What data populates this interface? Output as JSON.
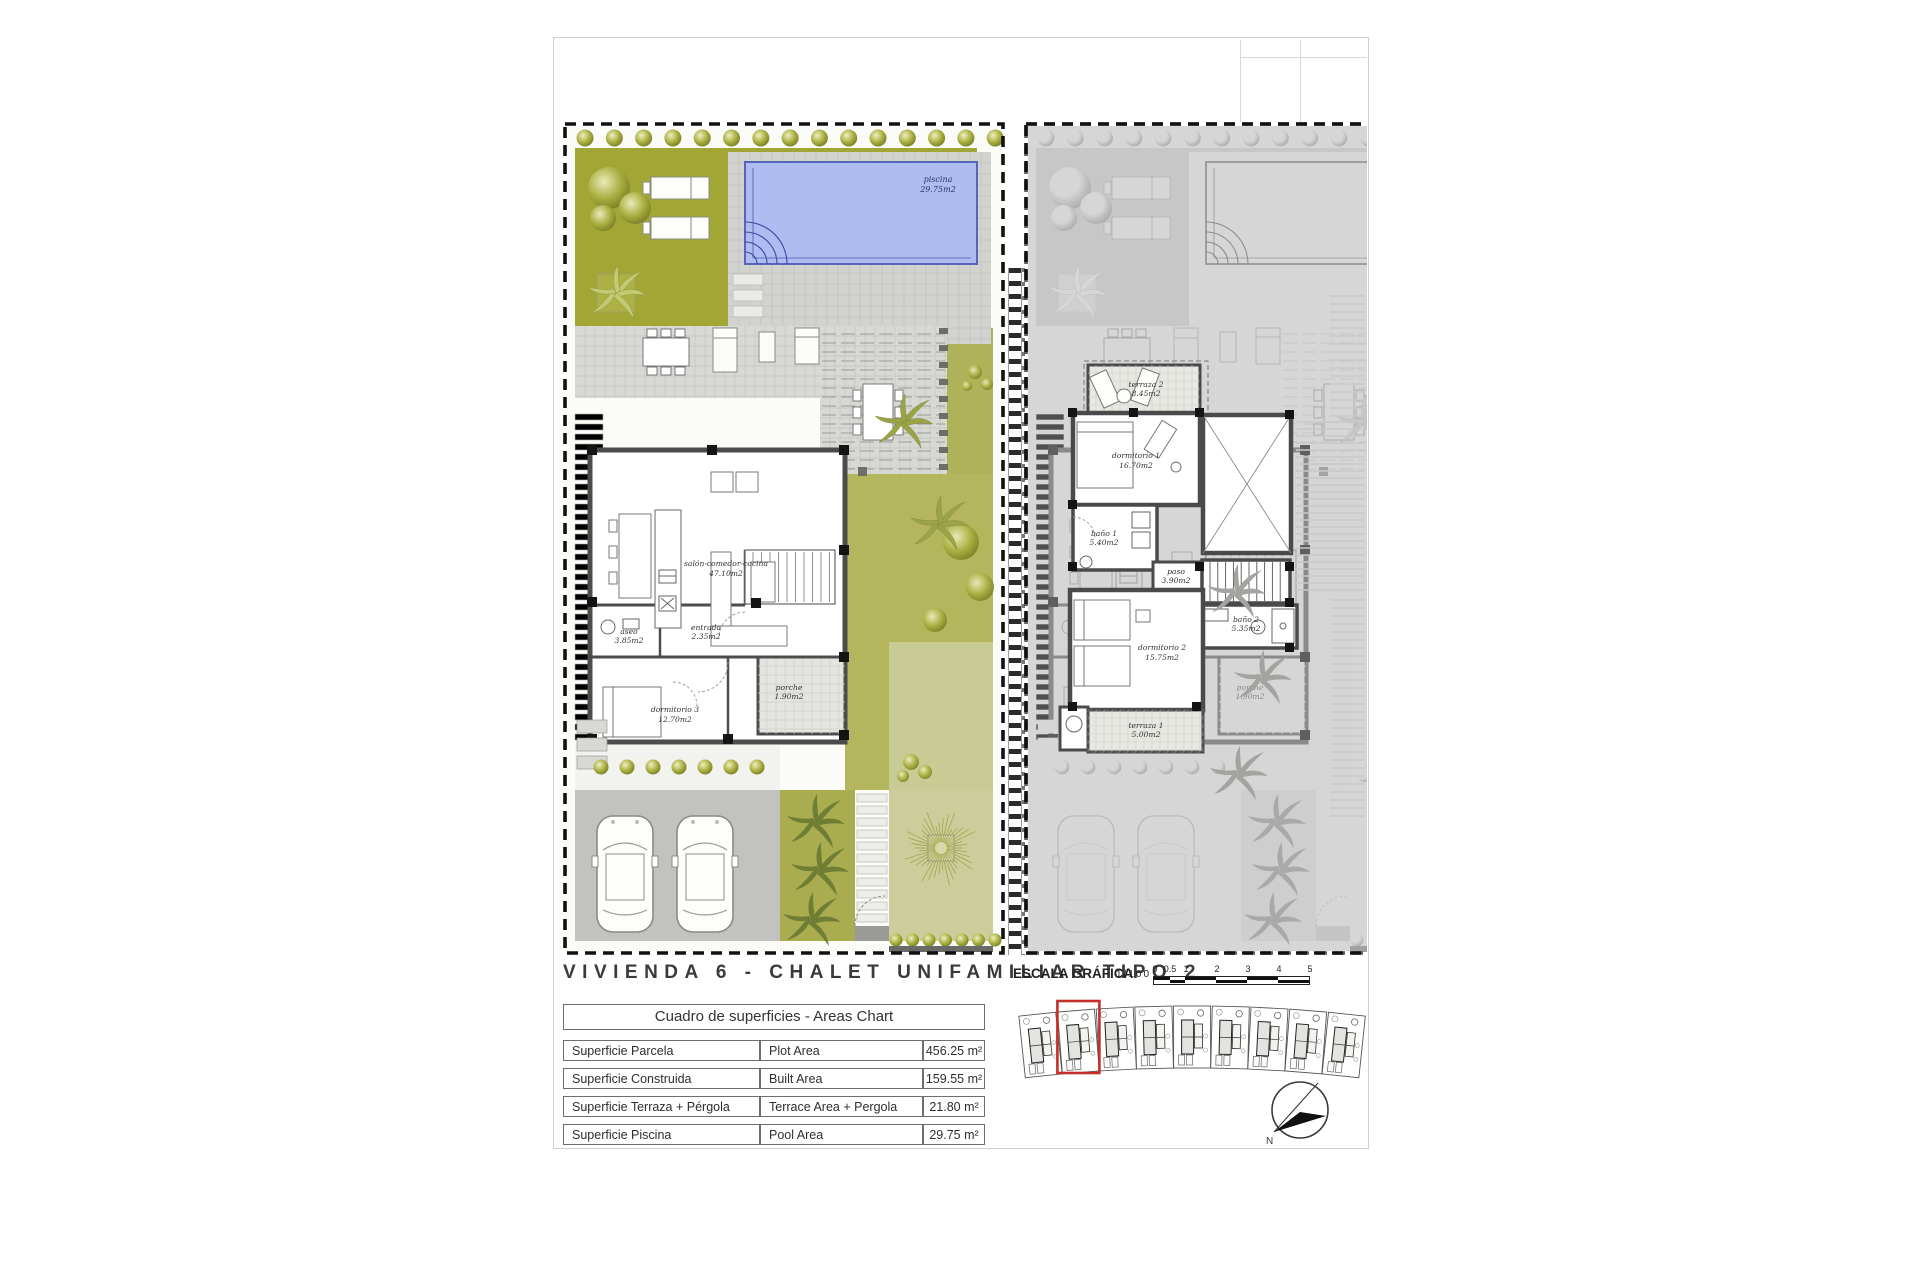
{
  "title": "VIVIENDA 6 - CHALET UNIFAMILIAR TIPO 2",
  "scale": {
    "label": "ESCALA GRÁFICA",
    "ratio": "1/100",
    "ticks": [
      "0",
      "0.5",
      "1",
      "2",
      "3",
      "4",
      "5"
    ]
  },
  "areas_table": {
    "header": "Cuadro de superficies - Areas Chart",
    "rows": [
      {
        "es": "Superficie Parcela",
        "en": "Plot Area",
        "value": "456.25 m²"
      },
      {
        "es": "Superficie Construida",
        "en": "Built Area",
        "value": "159.55 m²"
      },
      {
        "es": "Superficie Terraza + Pérgola",
        "en": "Terrace Area + Pergola",
        "value": "21.80 m²"
      },
      {
        "es": "Superficie Piscina",
        "en": "Pool Area",
        "value": "29.75 m²"
      }
    ]
  },
  "ground_floor": {
    "pool": {
      "label": "piscina",
      "area": "29.75m2"
    },
    "rooms": [
      {
        "label": "salón-comedor-cocina",
        "area": "47.10m2"
      },
      {
        "label": "entrada",
        "area": "2.35m2"
      },
      {
        "label": "aseo",
        "area": "3.85m2"
      },
      {
        "label": "dormitorio 3",
        "area": "12.70m2"
      },
      {
        "label": "porche",
        "area": "1.90m2"
      }
    ]
  },
  "upper_floor": {
    "rooms": [
      {
        "label": "terraza 2",
        "area": "8.45m2"
      },
      {
        "label": "dormitorio 1",
        "area": "16.70m2"
      },
      {
        "label": "baño 1",
        "area": "5.40m2"
      },
      {
        "label": "paso",
        "area": "3.90m2"
      },
      {
        "label": "baño 2",
        "area": "5.35m2"
      },
      {
        "label": "dormitorio 2",
        "area": "15.75m2"
      },
      {
        "label": "terraza 1",
        "area": "5.00m2"
      }
    ]
  },
  "site_plan": {
    "units": 9,
    "highlighted_unit": 4
  },
  "north": {
    "label": "N"
  }
}
